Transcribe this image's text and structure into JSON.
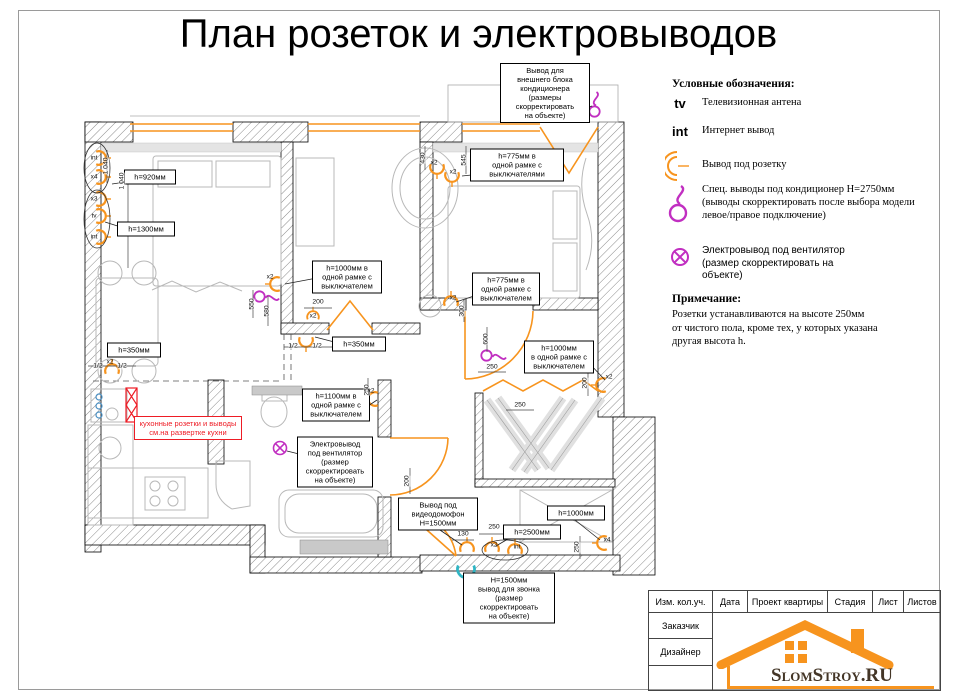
{
  "title": "План розеток и электровыводов",
  "legend": {
    "heading": "Условные обозначения:",
    "items": [
      {
        "symbol": "tv-antenna",
        "symbol_text": "tv",
        "label": "Телевизионная антена"
      },
      {
        "symbol": "internet-outlet",
        "symbol_text": "int",
        "label": "Интернет вывод"
      },
      {
        "symbol": "socket-outlet",
        "label": "Вывод под розетку"
      },
      {
        "symbol": "ac-outlet",
        "label": "Спец. выводы под кондиционер H=2750мм\n(выводы скорректировать после выбора модели\nлевое/правое подключение)"
      },
      {
        "symbol": "fan-outlet",
        "label": "Электровывод под вентилятор\n(размер скорректировать на\nобъекте)"
      }
    ],
    "note_heading": "Примечание:",
    "note_text": "Розетки устанавливаются на высоте 250мм\nот чистого пола, кроме тех, у которых указана\nдругая высота h."
  },
  "plan": {
    "callouts": [
      {
        "cx": 545,
        "cy": 93,
        "w": 84,
        "text": "Вывод для\nвнешнего блока\nкондиционера\n(размеры\nскорректировать\nна объекте)"
      },
      {
        "cx": 517,
        "cy": 165,
        "w": 88,
        "text": "h=775мм в\nодной рамке с\nвыключателями"
      },
      {
        "cx": 150,
        "cy": 177,
        "w": 46,
        "text": "h=920мм"
      },
      {
        "cx": 146,
        "cy": 229,
        "w": 52,
        "text": "h=1300мм"
      },
      {
        "cx": 347,
        "cy": 277,
        "w": 64,
        "text": "h=1000мм в\nодной рамке с\nвыключателем"
      },
      {
        "cx": 506,
        "cy": 289,
        "w": 62,
        "text": "h=775мм в\nодной рамке с\nвыключателем"
      },
      {
        "cx": 134,
        "cy": 350,
        "w": 48,
        "text": "h=350мм"
      },
      {
        "cx": 359,
        "cy": 344,
        "w": 48,
        "text": "h=350мм"
      },
      {
        "cx": 559,
        "cy": 357,
        "w": 64,
        "text": "h=1000мм\nв одной рамке с\nвыключателем"
      },
      {
        "cx": 336,
        "cy": 405,
        "w": 62,
        "text": "h=1100мм в\nодной рамке с\nвыключателем"
      },
      {
        "cx": 335,
        "cy": 462,
        "w": 70,
        "text": "Электровывод\nпод вентилятор\n(размер\nскорректировать\nна объекте)"
      },
      {
        "cx": 438,
        "cy": 514,
        "w": 74,
        "text": "Вывод под\nвидеодомофон\nН=1500мм"
      },
      {
        "cx": 532,
        "cy": 532,
        "w": 52,
        "text": "h=2500мм"
      },
      {
        "cx": 576,
        "cy": 513,
        "w": 52,
        "text": "h=1000мм"
      },
      {
        "cx": 509,
        "cy": 598,
        "w": 86,
        "text": "Н=1500мм\nвывод для звонка\n(размер\nскорректировать\nна объекте)"
      },
      {
        "cx": 188,
        "cy": 428,
        "w": 102,
        "red": true,
        "text": "кухонные розетки и выводы\nсм.на развертке кухни"
      }
    ],
    "dims": [
      {
        "t": "1 040",
        "x": 106,
        "y": 166,
        "r": -90
      },
      {
        "t": "1 040",
        "x": 122,
        "y": 181,
        "r": -90
      },
      {
        "t": "430",
        "x": 423,
        "y": 158,
        "r": -90
      },
      {
        "t": "545",
        "x": 464,
        "y": 160,
        "r": -90
      },
      {
        "t": "550",
        "x": 252,
        "y": 304,
        "r": -90
      },
      {
        "t": "580",
        "x": 267,
        "y": 311,
        "r": -90
      },
      {
        "t": "300",
        "x": 462,
        "y": 311,
        "r": -90
      },
      {
        "t": "200",
        "x": 318,
        "y": 302,
        "r": 0
      },
      {
        "t": "600",
        "x": 486,
        "y": 339,
        "r": -90
      },
      {
        "t": "250",
        "x": 492,
        "y": 367,
        "r": 0
      },
      {
        "t": "250",
        "x": 520,
        "y": 405,
        "r": 0
      },
      {
        "t": "200",
        "x": 585,
        "y": 383,
        "r": -90
      },
      {
        "t": "250",
        "x": 367,
        "y": 390,
        "r": -90
      },
      {
        "t": "200",
        "x": 407,
        "y": 481,
        "r": -90
      },
      {
        "t": "130",
        "x": 463,
        "y": 534,
        "r": 0
      },
      {
        "t": "250",
        "x": 494,
        "y": 527,
        "r": 0
      },
      {
        "t": "250",
        "x": 577,
        "y": 547,
        "r": -90
      },
      {
        "t": "1/2",
        "x": 98,
        "y": 366,
        "r": 0
      },
      {
        "t": "1/2",
        "x": 122,
        "y": 366,
        "r": 0
      },
      {
        "t": "1/2",
        "x": 293,
        "y": 346,
        "r": 0
      },
      {
        "t": "1/2",
        "x": 317,
        "y": 346,
        "r": 0
      }
    ],
    "socket_labels": [
      {
        "t": "int",
        "x": 94,
        "y": 158
      },
      {
        "t": "x4",
        "x": 94,
        "y": 177
      },
      {
        "t": "x3",
        "x": 94,
        "y": 199
      },
      {
        "t": "tv",
        "x": 94,
        "y": 216
      },
      {
        "t": "int",
        "x": 94,
        "y": 237
      },
      {
        "t": "x2",
        "x": 110,
        "y": 362
      },
      {
        "t": "x2",
        "x": 270,
        "y": 277
      },
      {
        "t": "x2",
        "x": 313,
        "y": 316
      },
      {
        "t": "x2",
        "x": 434,
        "y": 163
      },
      {
        "t": "x2",
        "x": 453,
        "y": 172
      },
      {
        "t": "x2",
        "x": 453,
        "y": 298
      },
      {
        "t": "x2",
        "x": 609,
        "y": 377
      },
      {
        "t": "x2",
        "x": 371,
        "y": 391
      },
      {
        "t": "x2",
        "x": 494,
        "y": 545
      },
      {
        "t": "int",
        "x": 517,
        "y": 547
      },
      {
        "t": "x4",
        "x": 607,
        "y": 540
      }
    ]
  },
  "titleblock": {
    "header_cells": [
      "Изм. кол.уч.",
      "Дата",
      "Проект квартиры",
      "Стадия",
      "Лист",
      "Листов"
    ],
    "row_labels": [
      "Заказчик",
      "Дизайнер"
    ],
    "logo_text": "SlomStroy.RU"
  },
  "colors": {
    "accent_orange": "#F7941E",
    "magenta": "#C12FC1",
    "cyan": "#2FB5C4",
    "red": "#EE1C25"
  }
}
